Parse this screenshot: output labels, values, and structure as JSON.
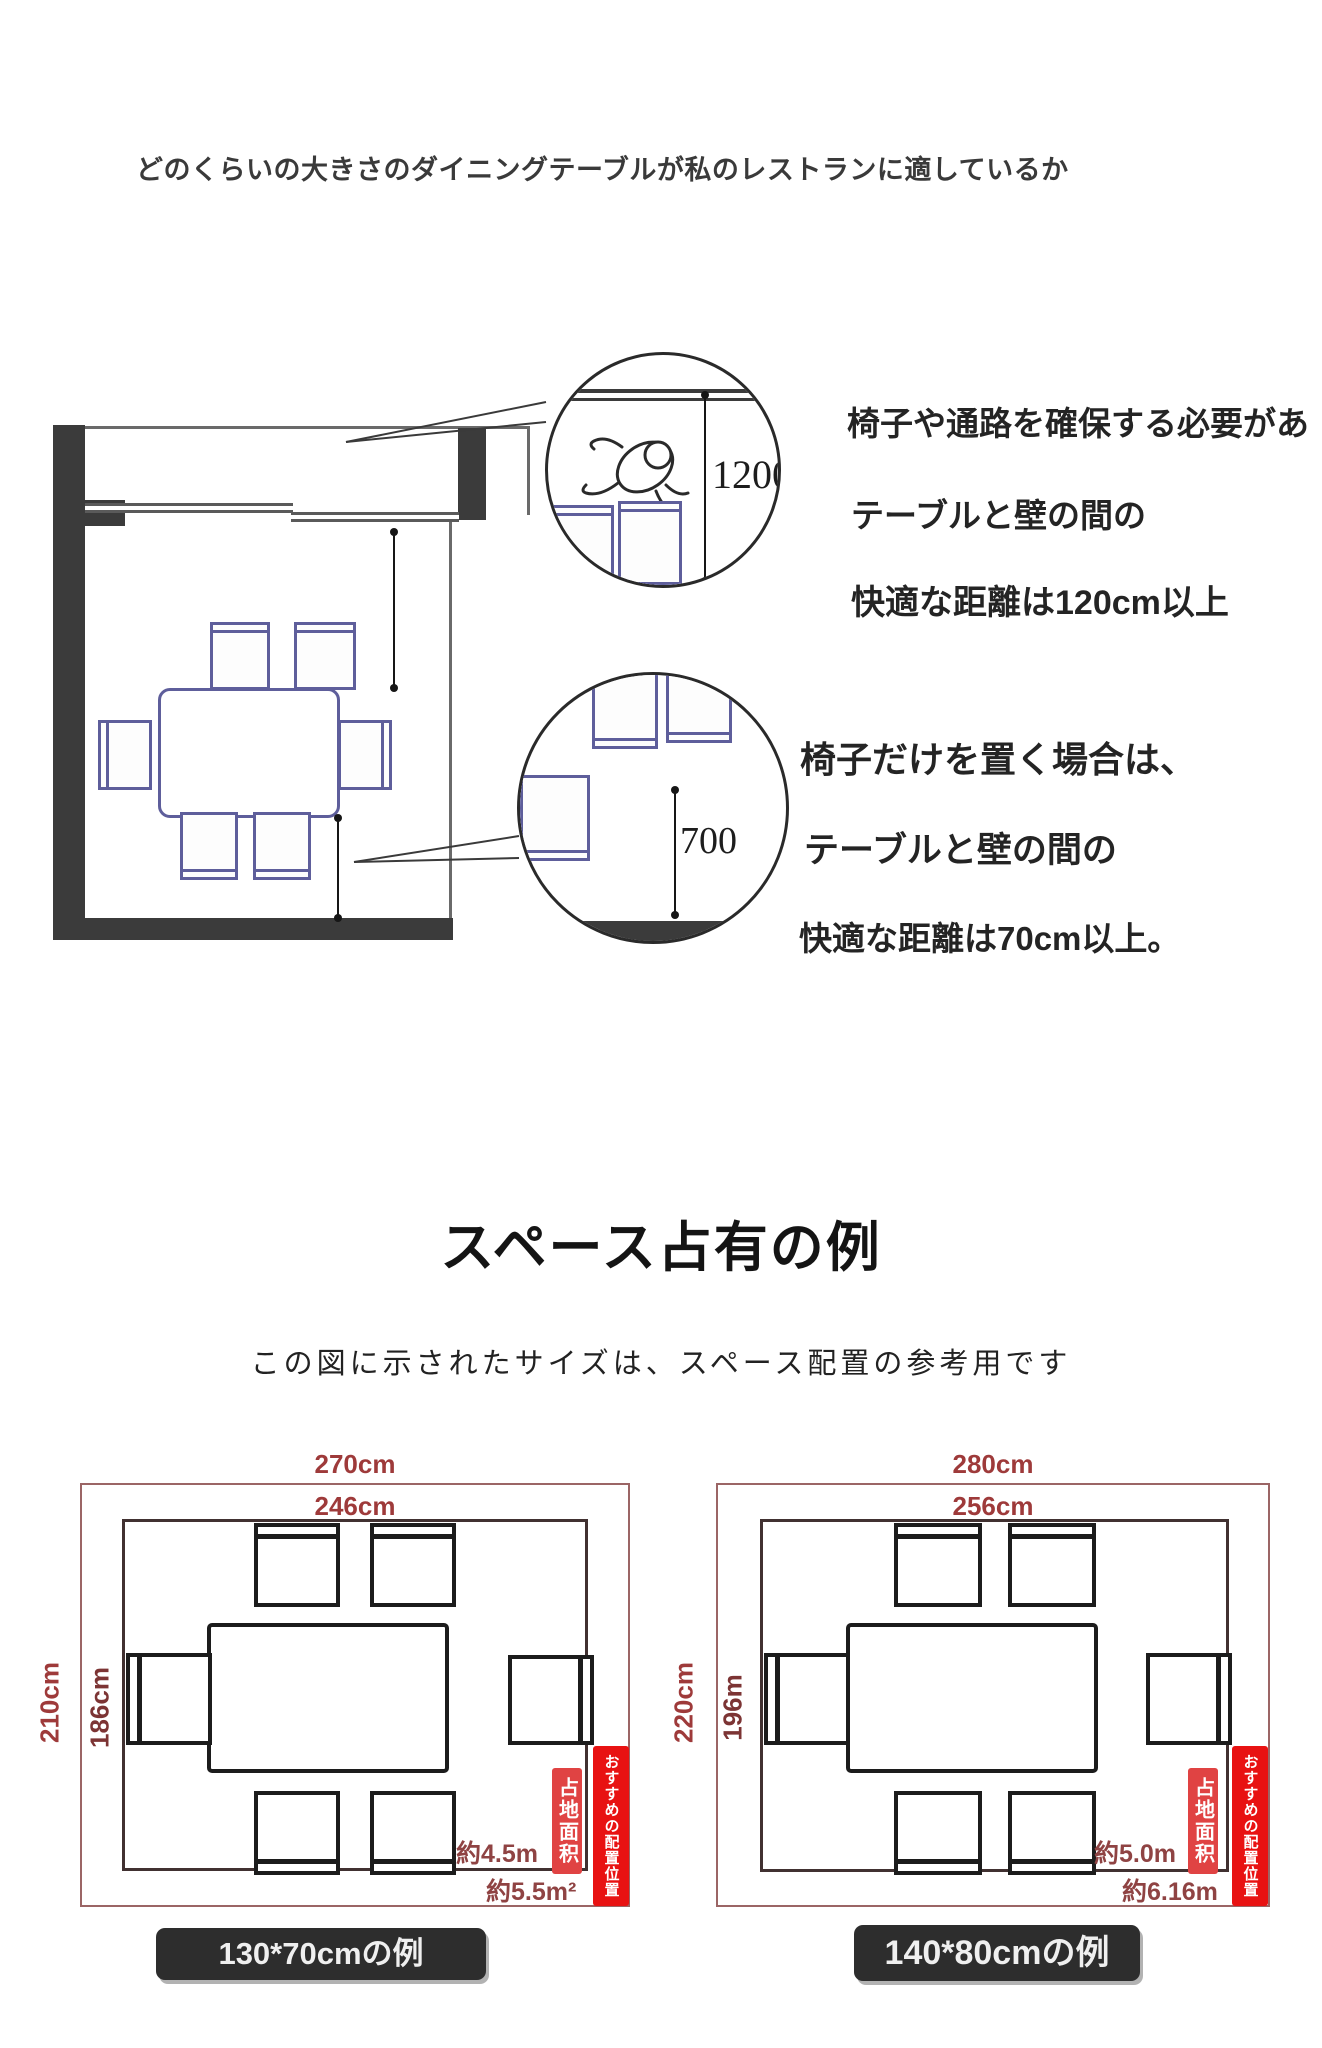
{
  "heading": "どのくらいの大きさのダイニングテーブルが私のレストランに適しているか",
  "plan": {
    "wall_clearance_mm": "1200",
    "chair_clearance_mm": "700"
  },
  "notes": {
    "aisle": {
      "line1": "椅子や通路を確保する必要があ",
      "line2": "テーブルと壁の間の",
      "line3": "快適な距離は120cm以上"
    },
    "chair_only": {
      "line1": "椅子だけを置く場合は、",
      "line2": "テーブルと壁の間の",
      "line3": "快適な距離は70cm以上。"
    }
  },
  "section": {
    "title": "スペース占有の例",
    "subtitle": "この図に示されたサイズは、スペース配置の参考用です"
  },
  "diagrams": {
    "left": {
      "outer_width": "270cm",
      "inner_width": "246cm",
      "outer_depth": "210cm",
      "inner_depth": "186cm",
      "area_line1": "約4.5m",
      "area_line2": "約5.5m²",
      "badge_area": "占地面积",
      "badge_recommend": "おすすめの配置位置",
      "caption": "130*70cmの例"
    },
    "right": {
      "outer_width": "280cm",
      "inner_width": "256cm",
      "outer_depth": "220cm",
      "inner_depth": "196m",
      "area_line1": "約5.0m",
      "area_line2": "約6.16m",
      "badge_area": "占地面积",
      "badge_recommend": "おすすめの配置位置",
      "caption": "140*80cmの例"
    }
  },
  "colors": {
    "wall": "#3b3b3b",
    "furniture_outline": "#5e5e9b",
    "dimension_red": "#9e3a3a",
    "badge_red": "#e81212",
    "caption_bar": "#2d2d2d"
  }
}
